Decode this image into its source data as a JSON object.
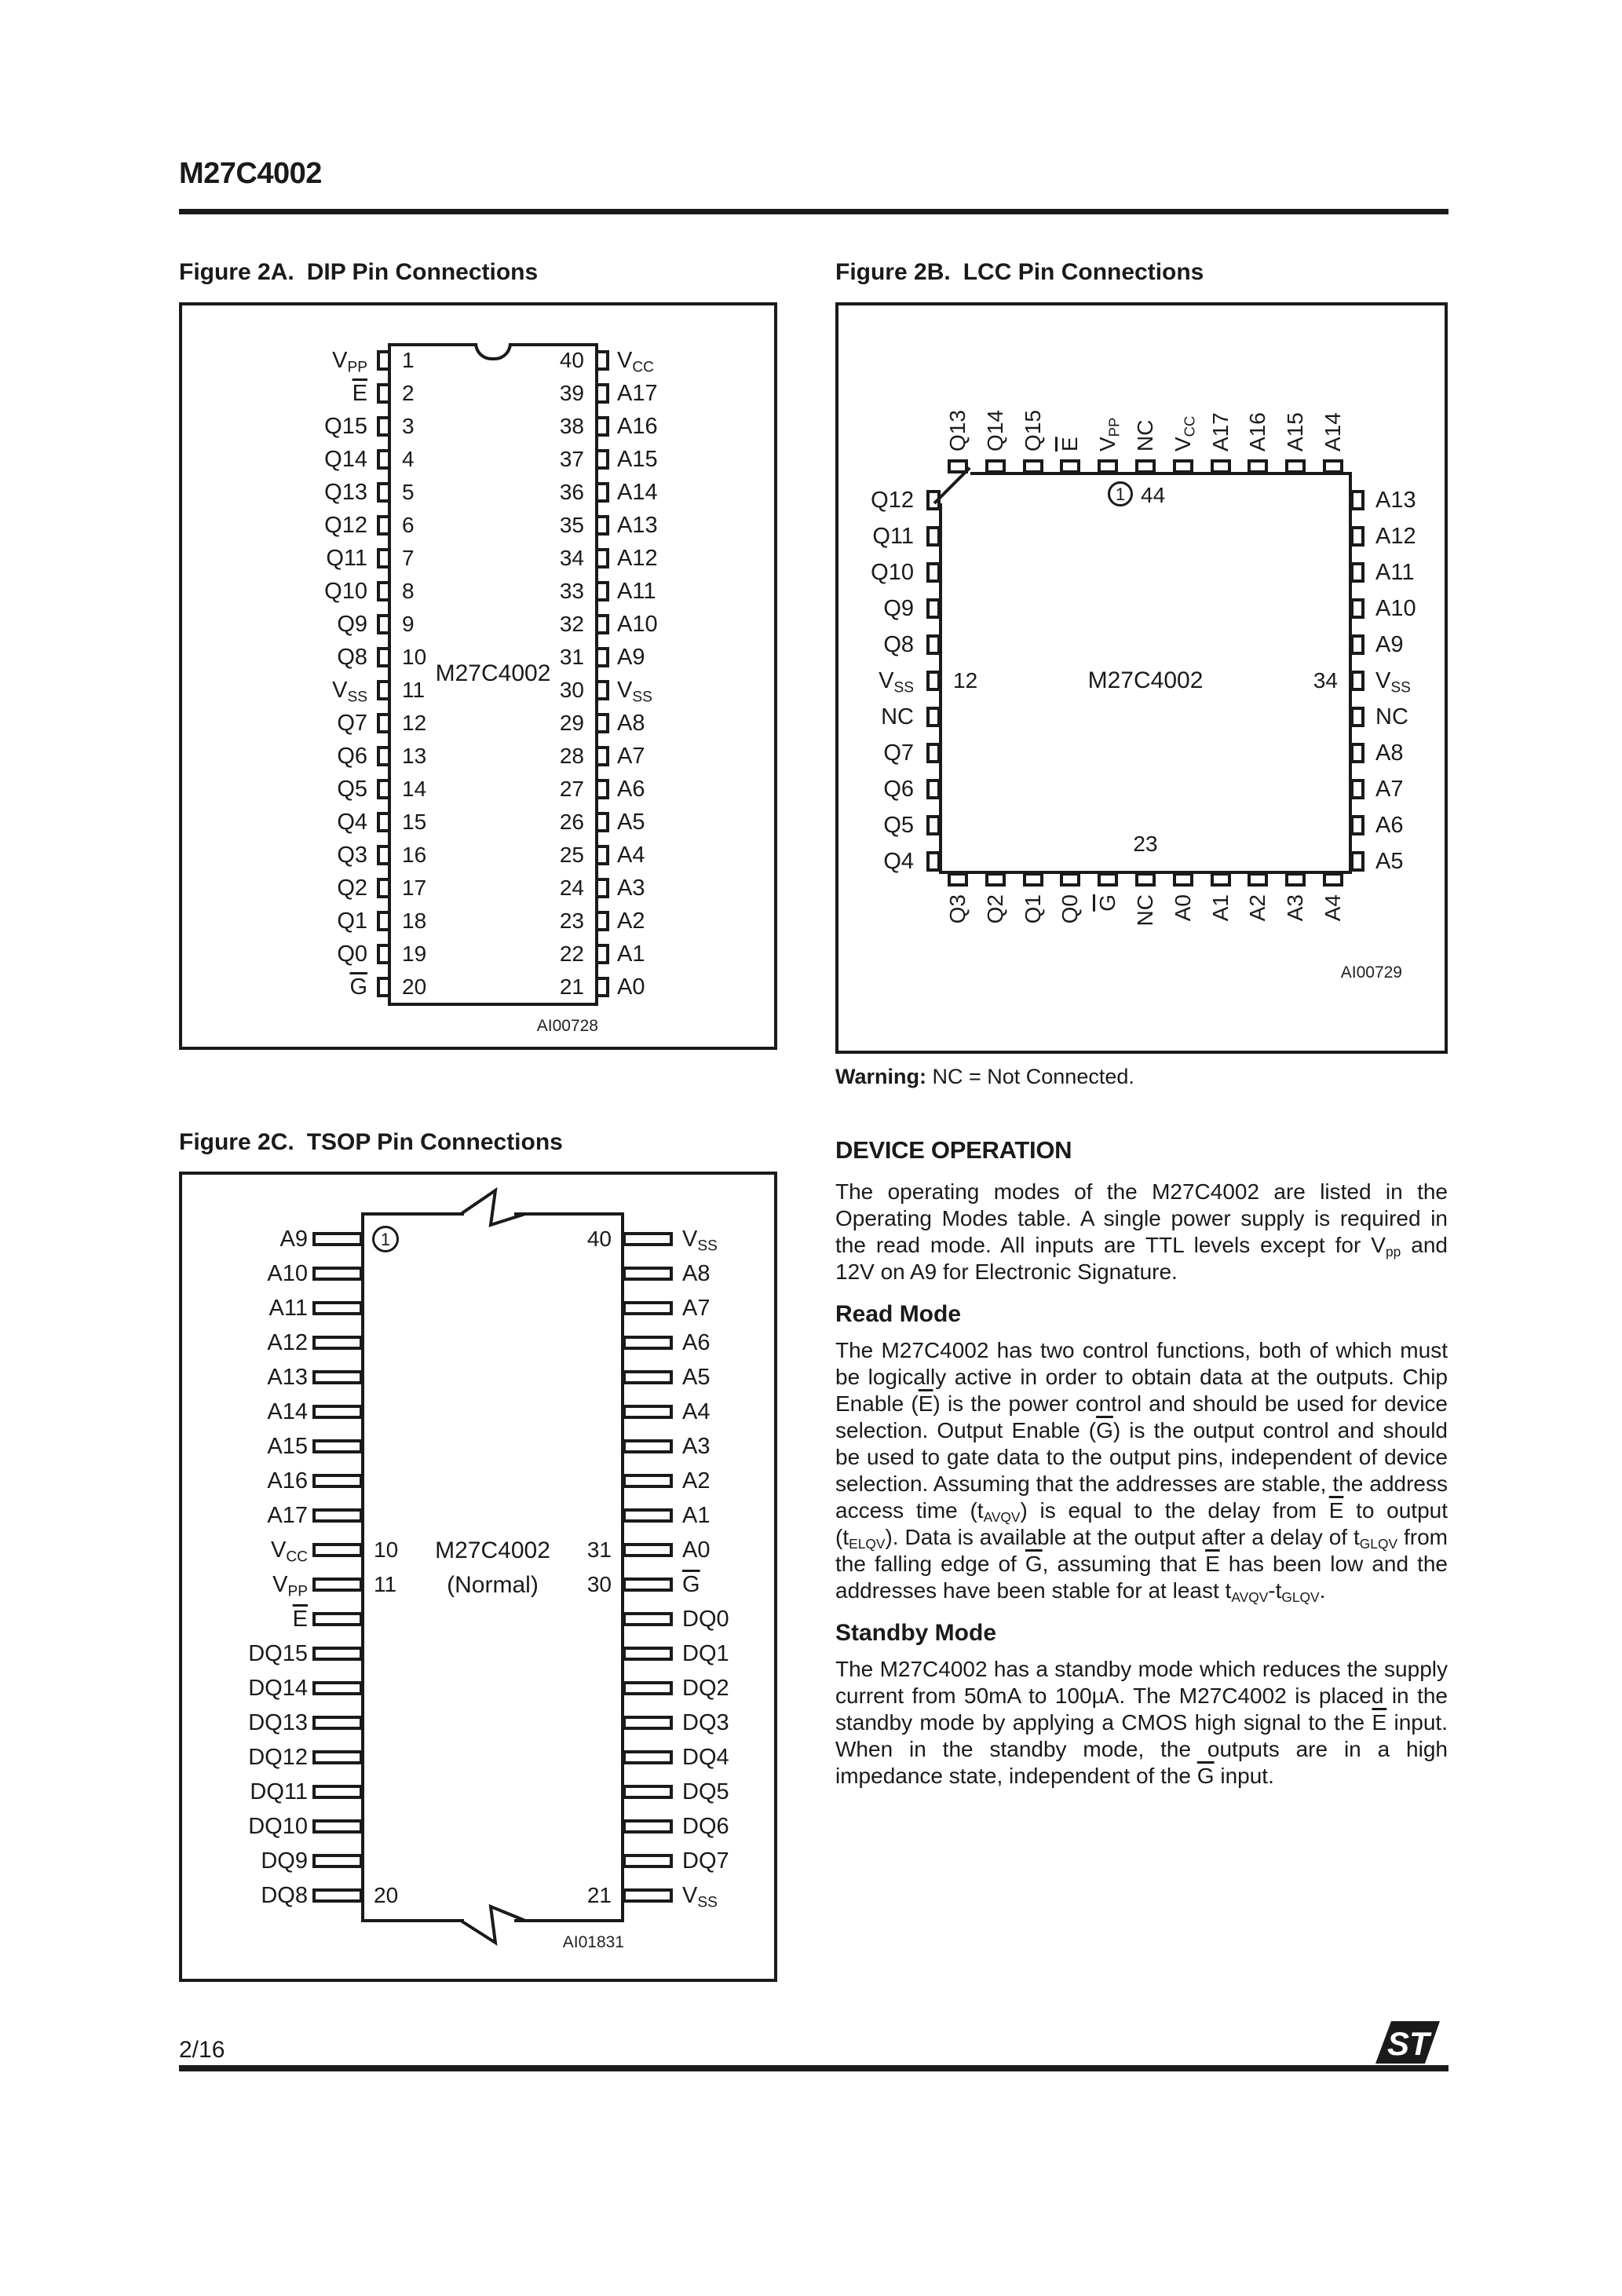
{
  "page": {
    "title": "M27C4002",
    "page_number": "2/16",
    "brand_logo": "ST"
  },
  "figures": {
    "dip": {
      "caption_label": "Figure 2A.",
      "caption_title": "DIP Pin Connections",
      "chip_label": "M27C4002",
      "code": "AI00728",
      "left_pins": [
        "V_PP",
        "~E",
        "Q15",
        "Q14",
        "Q13",
        "Q12",
        "Q11",
        "Q10",
        "Q9",
        "Q8",
        "V_SS",
        "Q7",
        "Q6",
        "Q5",
        "Q4",
        "Q3",
        "Q2",
        "Q1",
        "Q0",
        "~G"
      ],
      "left_numbers": [
        "1",
        "2",
        "3",
        "4",
        "5",
        "6",
        "7",
        "8",
        "9",
        "10",
        "11",
        "12",
        "13",
        "14",
        "15",
        "16",
        "17",
        "18",
        "19",
        "20"
      ],
      "right_pins": [
        "V_CC",
        "A17",
        "A16",
        "A15",
        "A14",
        "A13",
        "A12",
        "A11",
        "A10",
        "A9",
        "V_SS",
        "A8",
        "A7",
        "A6",
        "A5",
        "A4",
        "A3",
        "A2",
        "A1",
        "A0"
      ],
      "right_numbers": [
        "40",
        "39",
        "38",
        "37",
        "36",
        "35",
        "34",
        "33",
        "32",
        "31",
        "30",
        "29",
        "28",
        "27",
        "26",
        "25",
        "24",
        "23",
        "22",
        "21"
      ]
    },
    "lcc": {
      "caption_label": "Figure 2B.",
      "caption_title": "LCC Pin Connections",
      "chip_label": "M27C4002",
      "code": "AI00729",
      "top_pins": [
        "Q13",
        "Q14",
        "Q15",
        "~E",
        "V_PP",
        "NC",
        "V_CC",
        "A17",
        "A16",
        "A15",
        "A14"
      ],
      "left_pins": [
        "Q12",
        "Q11",
        "Q10",
        "Q9",
        "Q8",
        "V_SS",
        "NC",
        "Q7",
        "Q6",
        "Q5",
        "Q4"
      ],
      "right_pins": [
        "A13",
        "A12",
        "A11",
        "A10",
        "A9",
        "V_SS",
        "NC",
        "A8",
        "A7",
        "A6",
        "A5"
      ],
      "bottom_pins": [
        "Q3",
        "Q2",
        "Q1",
        "Q0",
        "~G",
        "NC",
        "A0",
        "A1",
        "A2",
        "A3",
        "A4"
      ],
      "pin1_label": "1",
      "pin44_label": "44",
      "left_number": "12",
      "right_number": "34",
      "bottom_number": "23",
      "warning_bold": "Warning:",
      "warning_text": " NC = Not Connected."
    },
    "tsop": {
      "caption_label": "Figure 2C.",
      "caption_title": "TSOP Pin Connections",
      "chip_label": "M27C4002",
      "chip_sublabel": "(Normal)",
      "code": "AI01831",
      "left_pins": [
        {
          "label": "A9",
          "num": "1",
          "circled": true
        },
        {
          "label": "A10"
        },
        {
          "label": "A11"
        },
        {
          "label": "A12"
        },
        {
          "label": "A13"
        },
        {
          "label": "A14"
        },
        {
          "label": "A15"
        },
        {
          "label": "A16"
        },
        {
          "label": "A17"
        },
        {
          "label": "V_CC",
          "num": "10"
        },
        {
          "label": "V_PP",
          "num": "11"
        },
        {
          "label": "~E"
        },
        {
          "label": "DQ15"
        },
        {
          "label": "DQ14"
        },
        {
          "label": "DQ13"
        },
        {
          "label": "DQ12"
        },
        {
          "label": "DQ11"
        },
        {
          "label": "DQ10"
        },
        {
          "label": "DQ9"
        },
        {
          "label": "DQ8",
          "num": "20"
        }
      ],
      "right_pins": [
        {
          "label": "V_SS",
          "num": "40"
        },
        {
          "label": "A8"
        },
        {
          "label": "A7"
        },
        {
          "label": "A6"
        },
        {
          "label": "A5"
        },
        {
          "label": "A4"
        },
        {
          "label": "A3"
        },
        {
          "label": "A2"
        },
        {
          "label": "A1"
        },
        {
          "label": "A0",
          "num": "31"
        },
        {
          "label": "~G",
          "num": "30"
        },
        {
          "label": "DQ0"
        },
        {
          "label": "DQ1"
        },
        {
          "label": "DQ2"
        },
        {
          "label": "DQ3"
        },
        {
          "label": "DQ4"
        },
        {
          "label": "DQ5"
        },
        {
          "label": "DQ6"
        },
        {
          "label": "DQ7"
        },
        {
          "label": "V_SS",
          "num": "21"
        }
      ]
    }
  },
  "article": {
    "heading": "DEVICE OPERATION",
    "para1": [
      {
        "t": "The operating modes of the M27C4002 are listed in the Operating Modes table. A single power supply is required in the read mode.  All inputs are TTL levels except for V"
      },
      {
        "sub": "pp"
      },
      {
        "t": " and 12V on A9 for Electronic Signature."
      }
    ],
    "read_mode_heading": "Read Mode",
    "read_para": [
      {
        "t": "The M27C4002 has two control functions, both of which must be logically active in order to obtain data at the outputs.  Chip Enable ("
      },
      {
        "ov": "E"
      },
      {
        "t": ") is the power control and should be used for device selection. Output Enable ("
      },
      {
        "ov": "G"
      },
      {
        "t": ") is the output control and should be used to gate data to the output pins, independent of device selection.  Assuming that the addresses are stable, the address access time (t"
      },
      {
        "sub": "AVQV"
      },
      {
        "t": ") is equal to the delay from "
      },
      {
        "ov": "E"
      },
      {
        "t": " to output (t"
      },
      {
        "sub": "ELQV"
      },
      {
        "t": "). Data is available at the output after a delay of t"
      },
      {
        "sub": "GLQV"
      },
      {
        "t": " from the falling edge of "
      },
      {
        "ov": "G"
      },
      {
        "t": ", assuming that "
      },
      {
        "ov": "E"
      },
      {
        "t": " has been low and the addresses have been stable for at least t"
      },
      {
        "sub": "AVQV"
      },
      {
        "t": "-t"
      },
      {
        "sub": "GLQV"
      },
      {
        "t": "."
      }
    ],
    "standby_heading": "Standby Mode",
    "standby_para": [
      {
        "t": "The M27C4002 has a standby mode which reduces the supply current from 50mA to 100µA. The M27C4002 is placed in the standby mode by applying a CMOS high signal to the "
      },
      {
        "ov": "E"
      },
      {
        "t": " input.  When in the standby mode, the outputs are in a high impedance state, independent of the "
      },
      {
        "ov": "G"
      },
      {
        "t": " input."
      }
    ]
  }
}
